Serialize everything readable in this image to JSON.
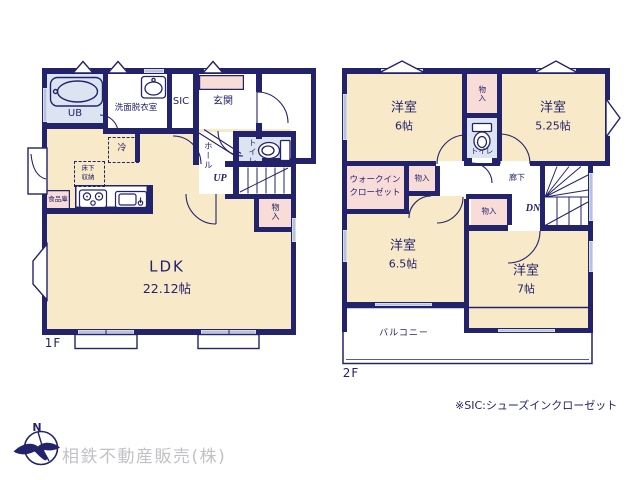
{
  "floor1": {
    "floor_label": "1F",
    "ub": "UB",
    "washroom": "洗面脱衣室",
    "sic": "SIC",
    "genkan": "玄関",
    "hall": "ホール",
    "toilet": "トイレ",
    "stairs_up": "UP",
    "closet": "物入",
    "fridge": "冷",
    "underfloor_line1": "床下",
    "underfloor_line2": "収納",
    "pantry": "食品庫",
    "ldk": "LDK",
    "ldk_size": "22.12帖"
  },
  "floor2": {
    "floor_label": "2F",
    "bedroom": "洋室",
    "size_r6": "6帖",
    "size_r525": "5.25帖",
    "size_r65": "6.5帖",
    "size_r7": "7帖",
    "wic_line1": "ウォークイン",
    "wic_line2": "クローゼット",
    "closet": "物入",
    "toilet": "トイレ",
    "corridor": "廊下",
    "stairs_down": "DN",
    "balcony": "バルコニー"
  },
  "footer": {
    "note": "※SIC:シューズインクローゼット",
    "company": "相鉄不動産販売(株)",
    "compass_north": "N"
  },
  "colors": {
    "wall": "#23236b",
    "room_floor": "#f8e9c9",
    "closet_pink": "#f8dcd8",
    "wet_blue": "#dce4f2",
    "window_gray": "#b9c2dd",
    "label_navy": "#23236b",
    "company_gray": "#c2c2c6"
  }
}
